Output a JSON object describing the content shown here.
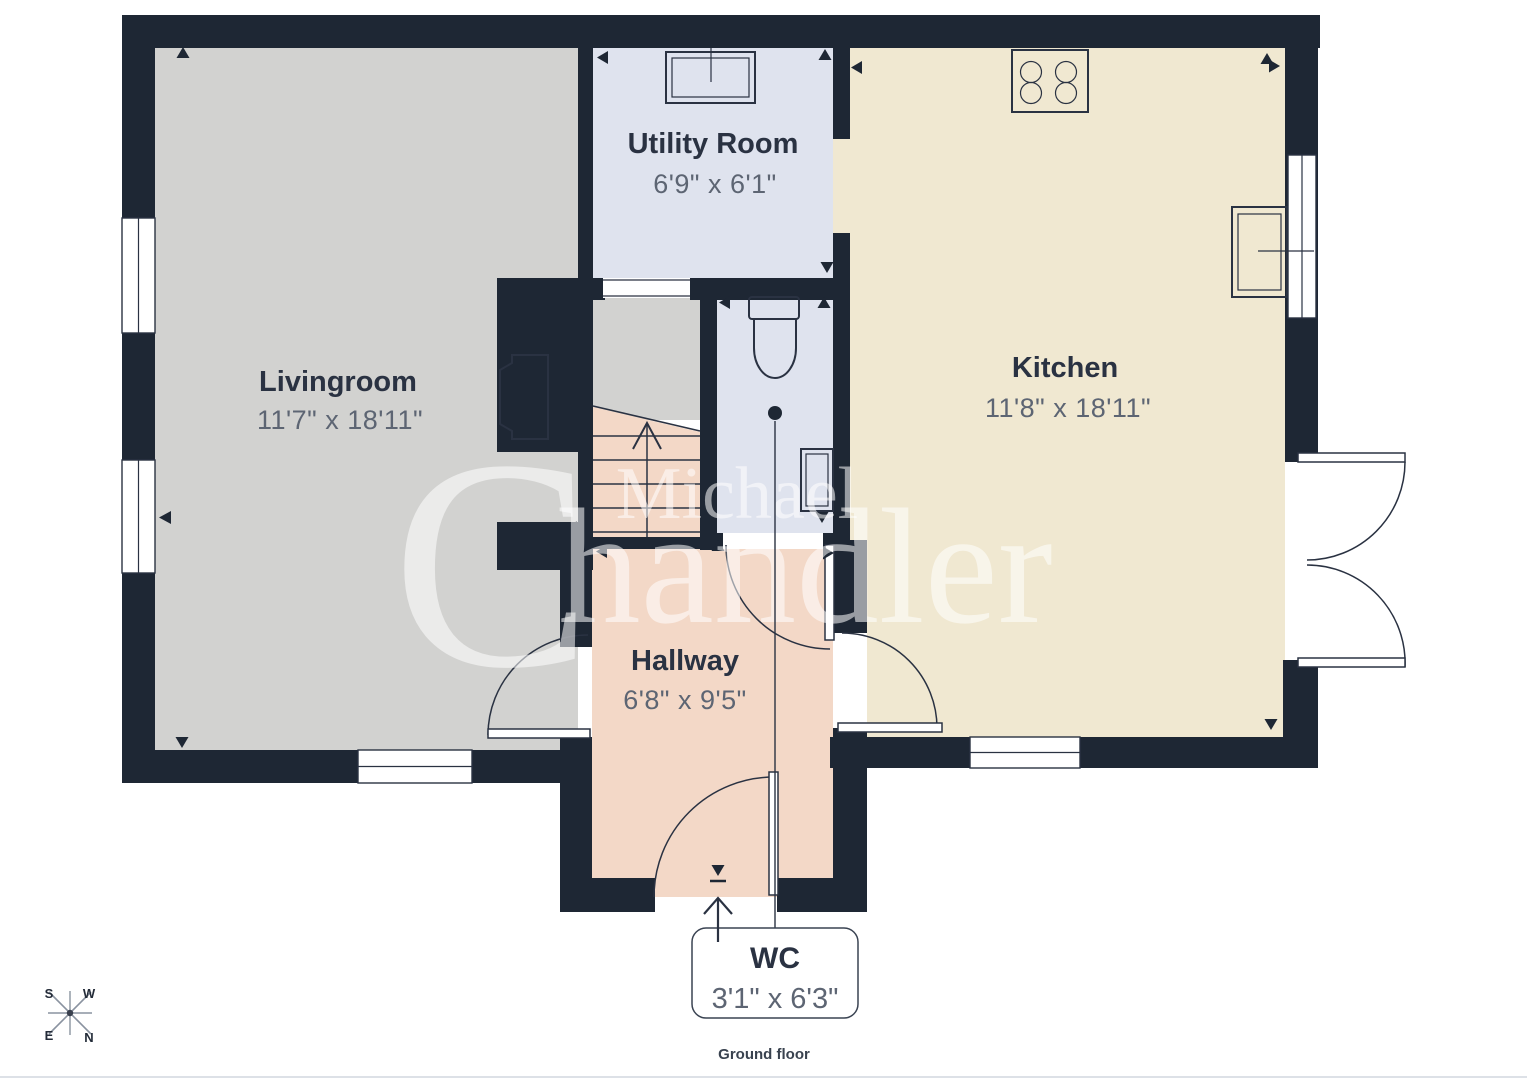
{
  "title": "Ground floor plan",
  "rooms": {
    "livingroom": {
      "name": "Livingroom",
      "dims": "11'7\" x 18'11\""
    },
    "utility": {
      "name": "Utility Room",
      "dims": "6'9\" x 6'1\""
    },
    "kitchen": {
      "name": "Kitchen",
      "dims": "11'8\" x 18'11\""
    },
    "hallway": {
      "name": "Hallway",
      "dims": "6'8\" x 9'5\""
    },
    "wc": {
      "name": "WC",
      "dims": "3'1\" x 6'3\""
    }
  },
  "caption": {
    "floor_label": "Ground floor"
  },
  "compass": {
    "n": "N",
    "s": "S",
    "e": "E",
    "w": "W"
  },
  "watermark": {
    "line1": "Michael",
    "line2_initial": "C",
    "line2_rest": "handler"
  },
  "colors": {
    "wall": "#1e2734",
    "livingroom_floor": "#d2d2d0",
    "landing_floor": "#d2d2d0",
    "utility_floor": "#dfe3ee",
    "wc_floor": "#dfe3ee",
    "kitchen_floor": "#f0e8d1",
    "hallway_floor": "#f3d8c7",
    "stairs_floor": "#f3d8c7",
    "label_text": "#2a3242",
    "dim_text": "#5d6573",
    "watermark_text": "#ffffff"
  },
  "icons": [
    "compass-icon",
    "stairs-icon",
    "toilet-icon",
    "hob-icon",
    "kitchen-sink-icon",
    "utility-sink-icon",
    "radiator-icon",
    "fireplace-icon",
    "entrance-arrow-icon"
  ]
}
